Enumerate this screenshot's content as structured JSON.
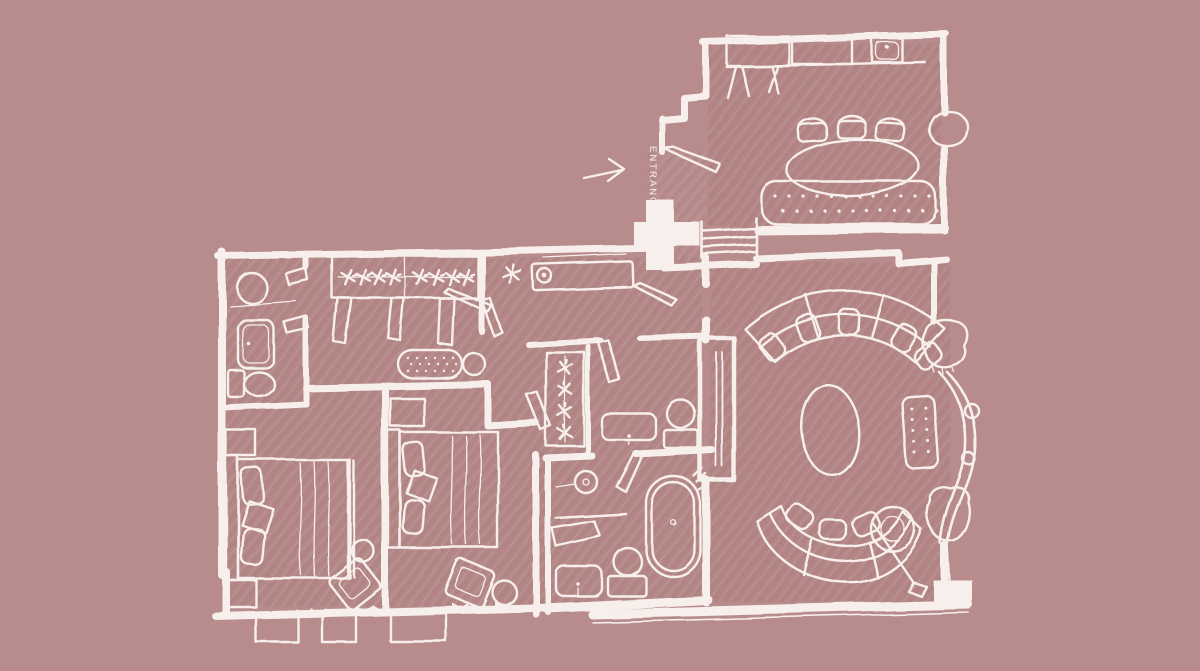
{
  "colors": {
    "background": "#b88c8c",
    "ink": "#f6efeb"
  },
  "entrance": {
    "label": "ENTRANCE",
    "arrow_direction": "pointing-right-into-plan"
  },
  "drawing": {
    "kind": "hand-sketched floor plan, white line art on dusty rose"
  }
}
